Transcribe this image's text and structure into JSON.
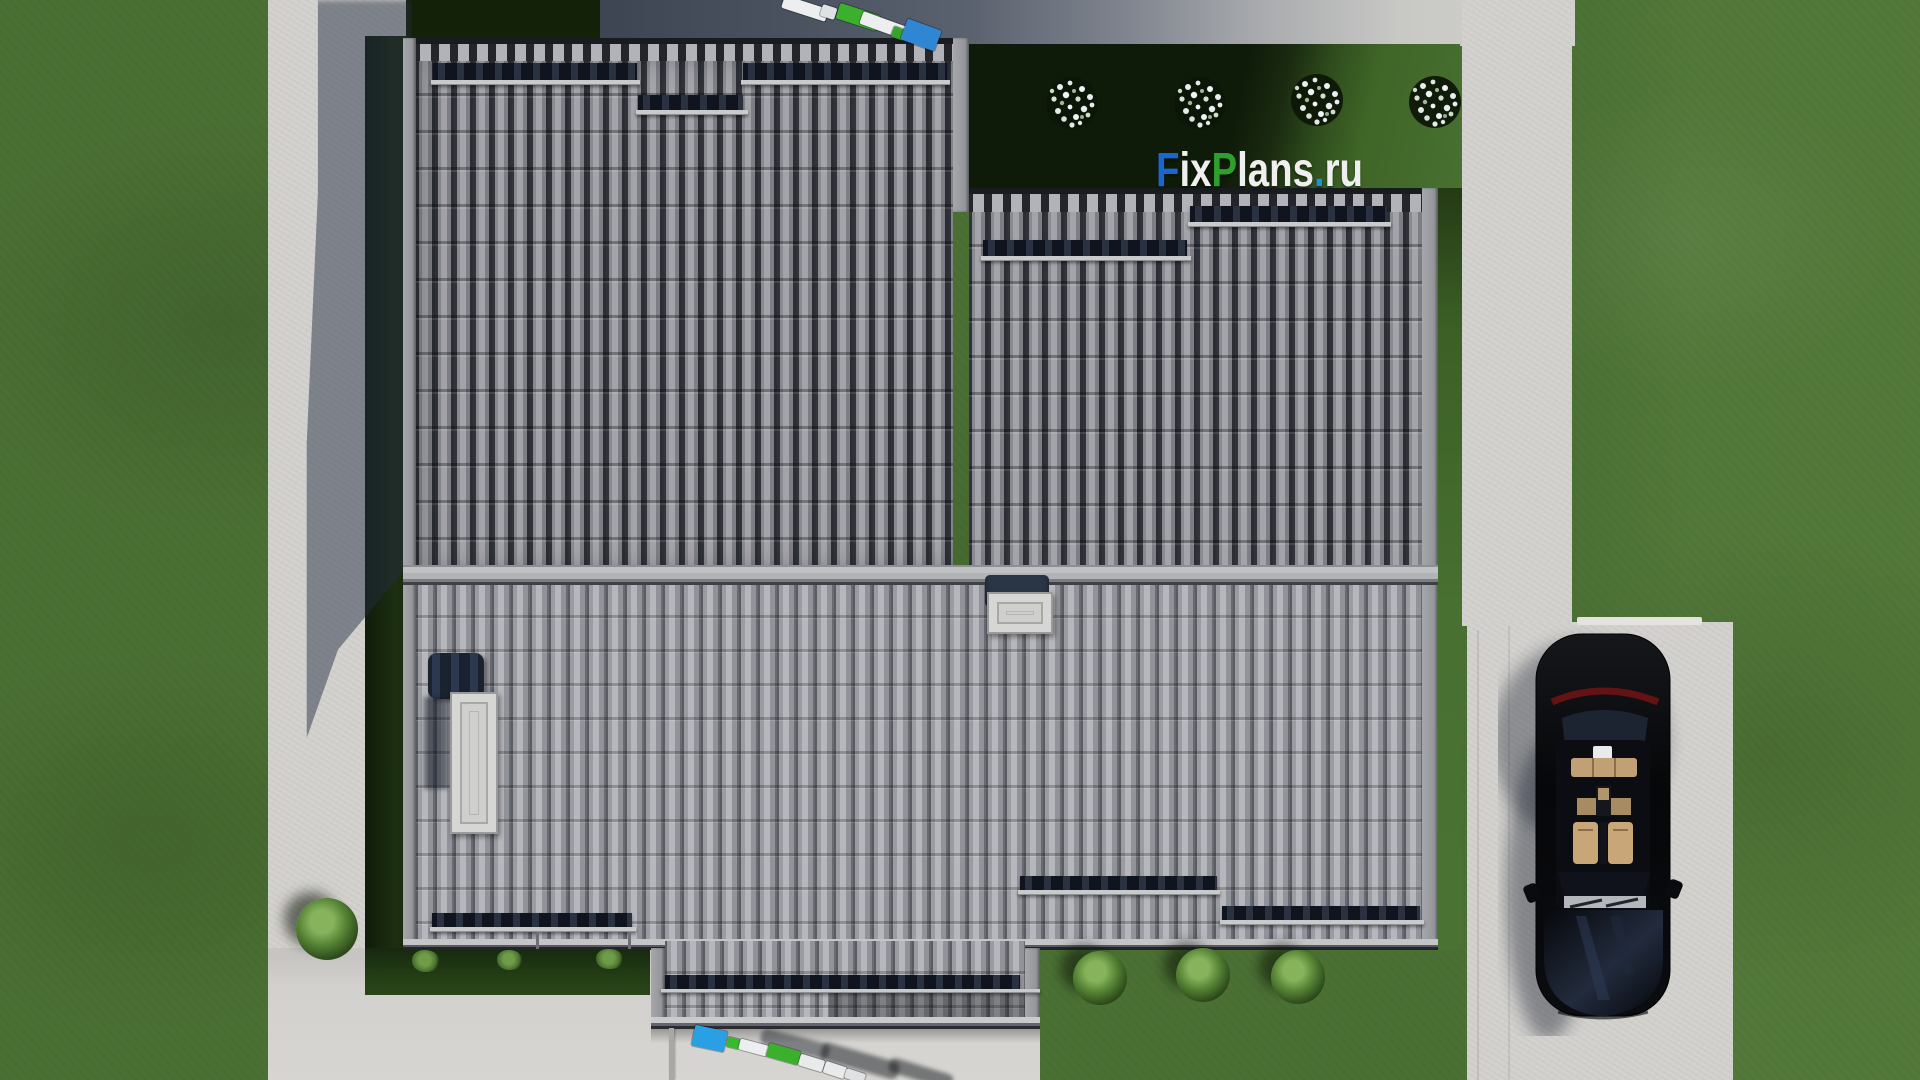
{
  "watermark": {
    "full": "FixPlans.ru",
    "f": "F",
    "ix": "ix",
    "p": "P",
    "lans": "lans",
    "dot": ".",
    "ru": "ru"
  },
  "palette": {
    "lawn": "#4b7034",
    "lawn_light": "#557c3b",
    "hedge": "#15230e",
    "hedge_lit": "#3f6527",
    "concrete": "#d2d1cd",
    "concrete_shadow": "#49505e",
    "roof_upper": "#7b7c82",
    "roof_upper_gap": "#23252d",
    "roof_upper_cap": "#a2a3a9",
    "roof_lower": "#95969b",
    "roof_lower_cap": "#b3b4b9",
    "ridge": "#b5b6b8",
    "fascia": "#9c9da1",
    "snow_bar": "#161a24",
    "bar_ledge": "#c9cacc",
    "chimney_white": "#d6d6d4",
    "chimney_navy": "#2a3646",
    "car_black": "#0a0b0d",
    "seat_tan": "#c9a678",
    "taillight_red": "#6e1414",
    "lounger_blue": "#2aa0e4",
    "lounger_green": "#3bb02d",
    "lounger_white": "#eceeef",
    "logo_blue": "#1a66cc",
    "logo_green": "#2f9e2d",
    "logo_dot": "#1f8fd6",
    "logo_white": "#efefef"
  },
  "scene": {
    "elements": [
      "lawn",
      "concrete-paths",
      "driveway",
      "tiled-roof-upper",
      "tiled-roof-lower",
      "roof-ridge",
      "snow-guard-bars",
      "chimney",
      "roof-hatch-chimney",
      "flowering-shrubs",
      "bushes",
      "sun-loungers",
      "black-car",
      "house-shadow"
    ]
  }
}
